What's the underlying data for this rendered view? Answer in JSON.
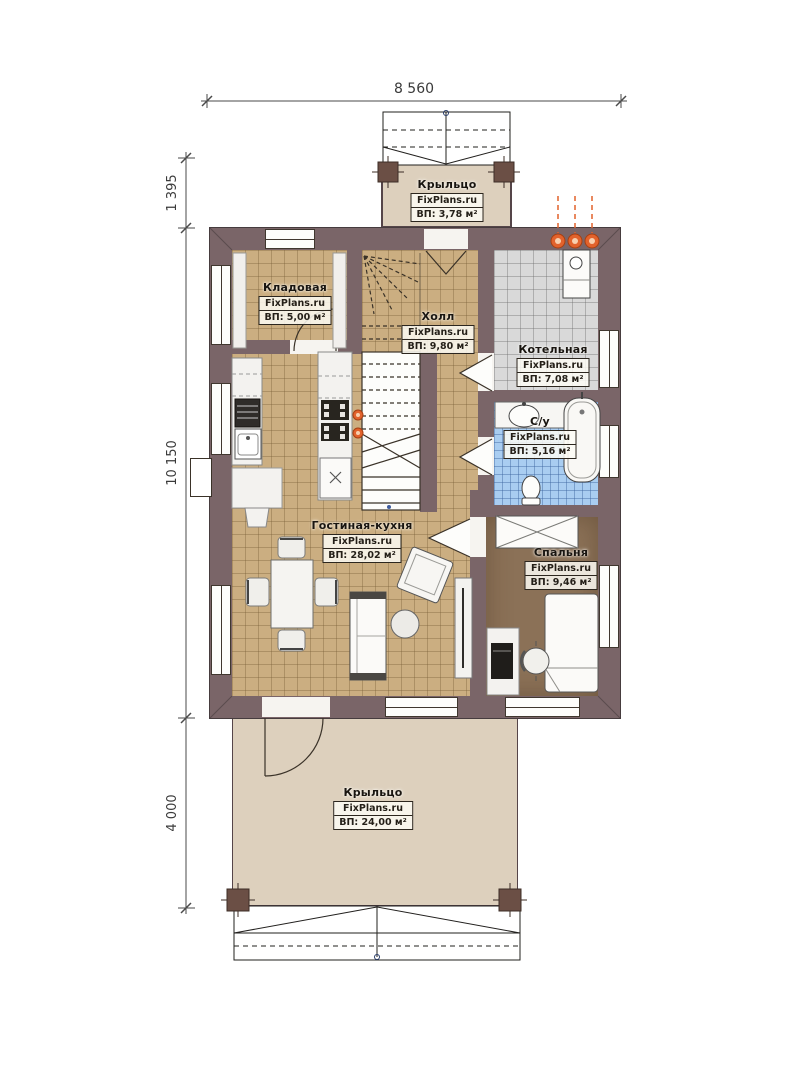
{
  "watermark": "FixPlans.ru",
  "dimensions": {
    "width_top": "8 560",
    "height_porch_top": "1 395",
    "height_main": "10 150",
    "height_porch_bottom": "4 000"
  },
  "rooms": {
    "porch_top": {
      "name": "Крыльцо",
      "brand": "FixPlans.ru",
      "area": "ВП: 3,78 м²"
    },
    "storage": {
      "name": "Кладовая",
      "brand": "FixPlans.ru",
      "area": "ВП: 5,00 м²"
    },
    "hall": {
      "name": "Холл",
      "brand": "FixPlans.ru",
      "area": "ВП: 9,80 м²"
    },
    "boiler": {
      "name": "Котельная",
      "brand": "FixPlans.ru",
      "area": "ВП: 7,08 м²"
    },
    "bathroom": {
      "name": "С/у",
      "brand": "FixPlans.ru",
      "area": "ВП: 5,16 м²"
    },
    "living_kitchen": {
      "name": "Гостиная-кухня",
      "brand": "FixPlans.ru",
      "area": "ВП: 28,02 м²"
    },
    "bedroom": {
      "name": "Спальня",
      "brand": "FixPlans.ru",
      "area": "ВП: 9,46 м²"
    },
    "porch_bottom": {
      "name": "Крыльцо",
      "brand": "FixPlans.ru",
      "area": "ВП: 24,00 м²"
    }
  },
  "colors": {
    "wall": "#7a6568",
    "floor_tile_beige": "#cbae81",
    "floor_tile_gray": "#d9d9d9",
    "floor_tile_blue": "#a9cdf1",
    "floor_bedroom_brown": "#8b7157",
    "floor_porch": "#ddd0bd",
    "accent_pipes_orange": "#e2622c"
  }
}
